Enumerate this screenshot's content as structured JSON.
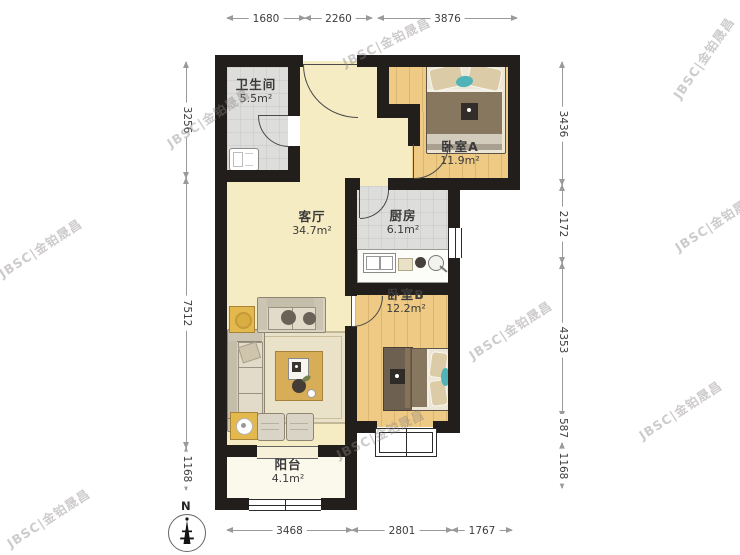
{
  "watermark": {
    "text": "JBSC|金铂晟昌"
  },
  "compass": {
    "label": "N"
  },
  "rooms": {
    "bathroom": {
      "name": "卫生间",
      "area": "5.5m²"
    },
    "bedroom_a": {
      "name": "卧室A",
      "area": "11.9m²"
    },
    "living_room": {
      "name": "客厅",
      "area": "34.7m²"
    },
    "kitchen": {
      "name": "厨房",
      "area": "6.1m²"
    },
    "bedroom_b": {
      "name": "卧室B",
      "area": "12.2m²"
    },
    "balcony": {
      "name": "阳台",
      "area": "4.1m²"
    }
  },
  "dimensions": {
    "top": [
      "1680",
      "2260",
      "3876"
    ],
    "left": [
      "3256",
      "7512",
      "1168"
    ],
    "right": [
      "3436",
      "2172",
      "4353",
      "587",
      "1168"
    ],
    "bottom": [
      "3468",
      "2801",
      "1767"
    ]
  },
  "colors": {
    "wall": "#211e1c",
    "wood_floor": "#eeca85",
    "tile_floor": "#dddddb",
    "living_floor": "#f6ecc3",
    "balcony_floor": "#fbf8ec",
    "accent_teal": "#4fb3b8",
    "furniture_gold": "#e3b94e",
    "dimension_text": "#3d3d3d",
    "watermark_gray": "#8c8686"
  }
}
